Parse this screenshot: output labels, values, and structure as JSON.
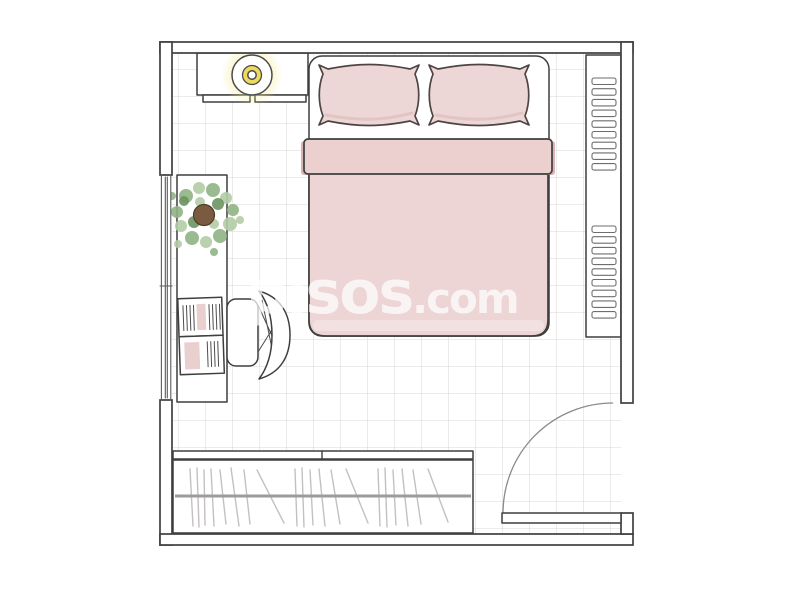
{
  "watermark": {
    "brand": "pisos",
    "suffix": ".com"
  },
  "colors": {
    "wall-line": "#3f3f3f",
    "window-line": "#5a5a5a",
    "grid-line": "#dbd6d6",
    "bed-pink": "#ecd5d4",
    "pillow-pink": "#edd7d6",
    "sheet-band": "#eccfcf",
    "sheet-shadow": "#d9b4b7",
    "duvet-hem": "#f3e3e2",
    "lamp-glow": "#f3ea8e",
    "lamp-yellow": "#ecd95e",
    "plant-green-light": "#b3cca4",
    "plant-green-mid": "#8fb483",
    "plant-green-dark": "#6b9460",
    "plant-pot": "#7a5b40",
    "notebook-pink": "#e9cfce",
    "clothes-line": "#c4c0c0",
    "rail-gray": "#9b9b9b",
    "door-arc": "#8a8a8a",
    "watermark-white": "rgba(255,255,255,0.72)"
  },
  "objects": {
    "room": "bedroom-floorplan",
    "bed": "double-bed",
    "pillow_count": 2,
    "dresser": "headboard-shelf-with-lamp",
    "lamp": "ceiling-lamp",
    "shelving": "wall-shelf-two-slat-sections",
    "shelf_slats_per_section": 9,
    "desk": "desk-with-notebook",
    "chair": "desk-chair",
    "plant": "potted-plant",
    "wardrobe": "wardrobe-with-hanging-clothes",
    "door": "swing-door-bottom-right",
    "window": "window-left-wall"
  }
}
